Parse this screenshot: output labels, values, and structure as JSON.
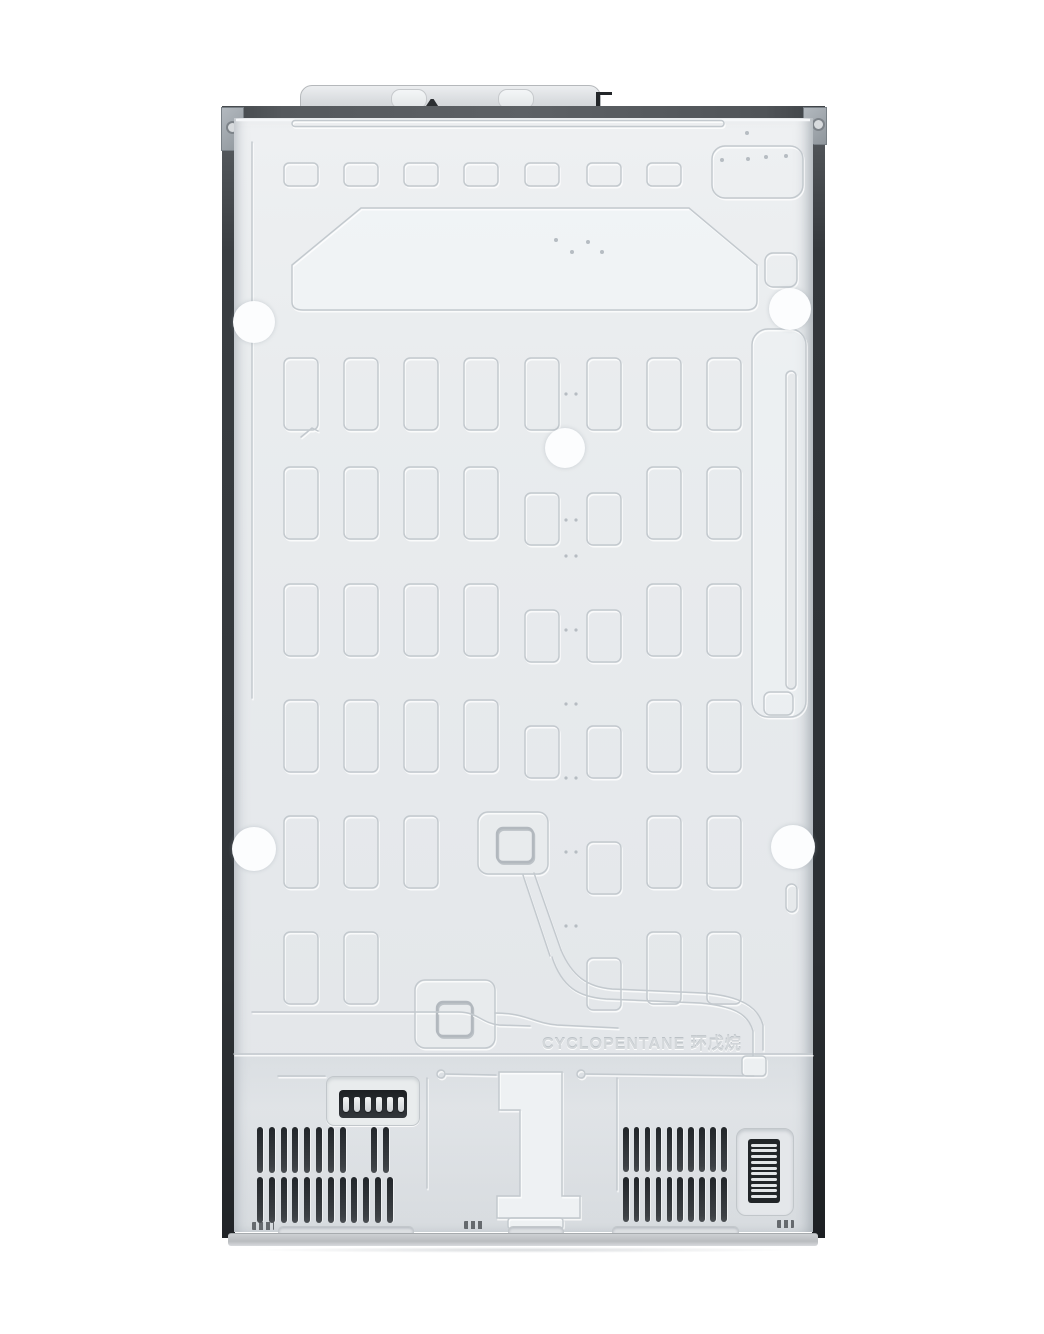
{
  "photo": {
    "subject": "Refrigerator rear panel",
    "background_color": "#ffffff",
    "embossed_text": "CYCLOPENTANE 环戊烷",
    "colors": {
      "panel": "#e9ecee",
      "trim_dark": "#3f4347",
      "corner_bracket": "#9ba2a8",
      "vent_slot": "#2b2f33",
      "shipping_pad": "#fdfdfe"
    }
  },
  "counts": {
    "shipping_pads": 5,
    "top_emboss_rects": 7,
    "emboss_grid_columns": 8,
    "emboss_grid_rows": 6,
    "connector_pins": 6,
    "left_vent_row1_slots": 8,
    "left_vent_row1_extra_slots": 2,
    "left_vent_row2_slots": 12,
    "right_vent_rows": 2,
    "right_vent_slots_per_row": 10,
    "side_grille_slats": 10,
    "bottom_stamp_marks": 3
  }
}
